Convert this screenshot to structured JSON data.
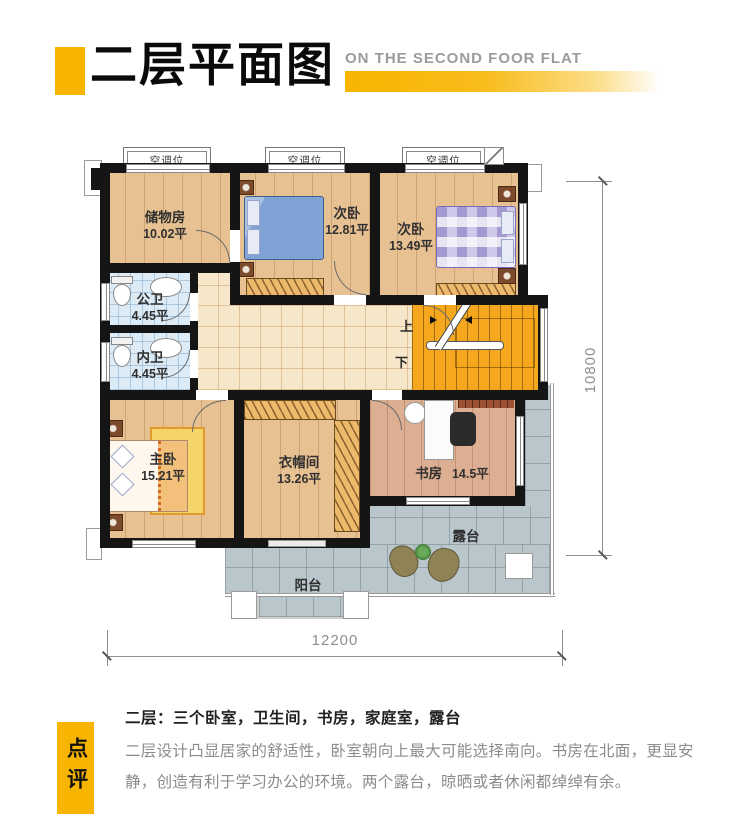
{
  "header": {
    "title": "二层平面图",
    "subtitle": "ON THE SECOND FOOR FLAT",
    "accent_color": "#F7B500"
  },
  "plan": {
    "ac_labels": [
      "空调位",
      "空调位",
      "空调位"
    ],
    "rooms": [
      {
        "name": "储物房",
        "area": "10.02平"
      },
      {
        "name": "次卧",
        "area": "12.81平"
      },
      {
        "name": "次卧",
        "area": "13.49平"
      },
      {
        "name": "公卫",
        "area": "4.45平"
      },
      {
        "name": "内卫",
        "area": "4.45平"
      },
      {
        "name": "主卧",
        "area": "15.21平"
      },
      {
        "name": "衣帽间",
        "area": "13.26平"
      },
      {
        "name": "书房",
        "area": "14.5平"
      },
      {
        "name": "露台",
        "area": ""
      },
      {
        "name": "阳台",
        "area": ""
      }
    ],
    "stairs": {
      "up": "上",
      "down": "下"
    },
    "dimensions": {
      "width": "12200",
      "height": "10800"
    }
  },
  "review": {
    "tab": "点评",
    "heading": "二层：三个卧室，卫生间，书房，家庭室，露台",
    "body": "二层设计凸显居家的舒适性，卧室朝向上最大可能选择南向。书房在北面，更显安静，创造有利于学习办公的环境。两个露台，晾晒或者休闲都绰绰有余。"
  },
  "colors": {
    "accent": "#F7B500",
    "wall": "#151515",
    "stairs": "#F5A81D",
    "wood_floor": "#E8C193",
    "outdoor_tile": "#B9C6CB",
    "bath_tile": "#DCEBF5"
  }
}
